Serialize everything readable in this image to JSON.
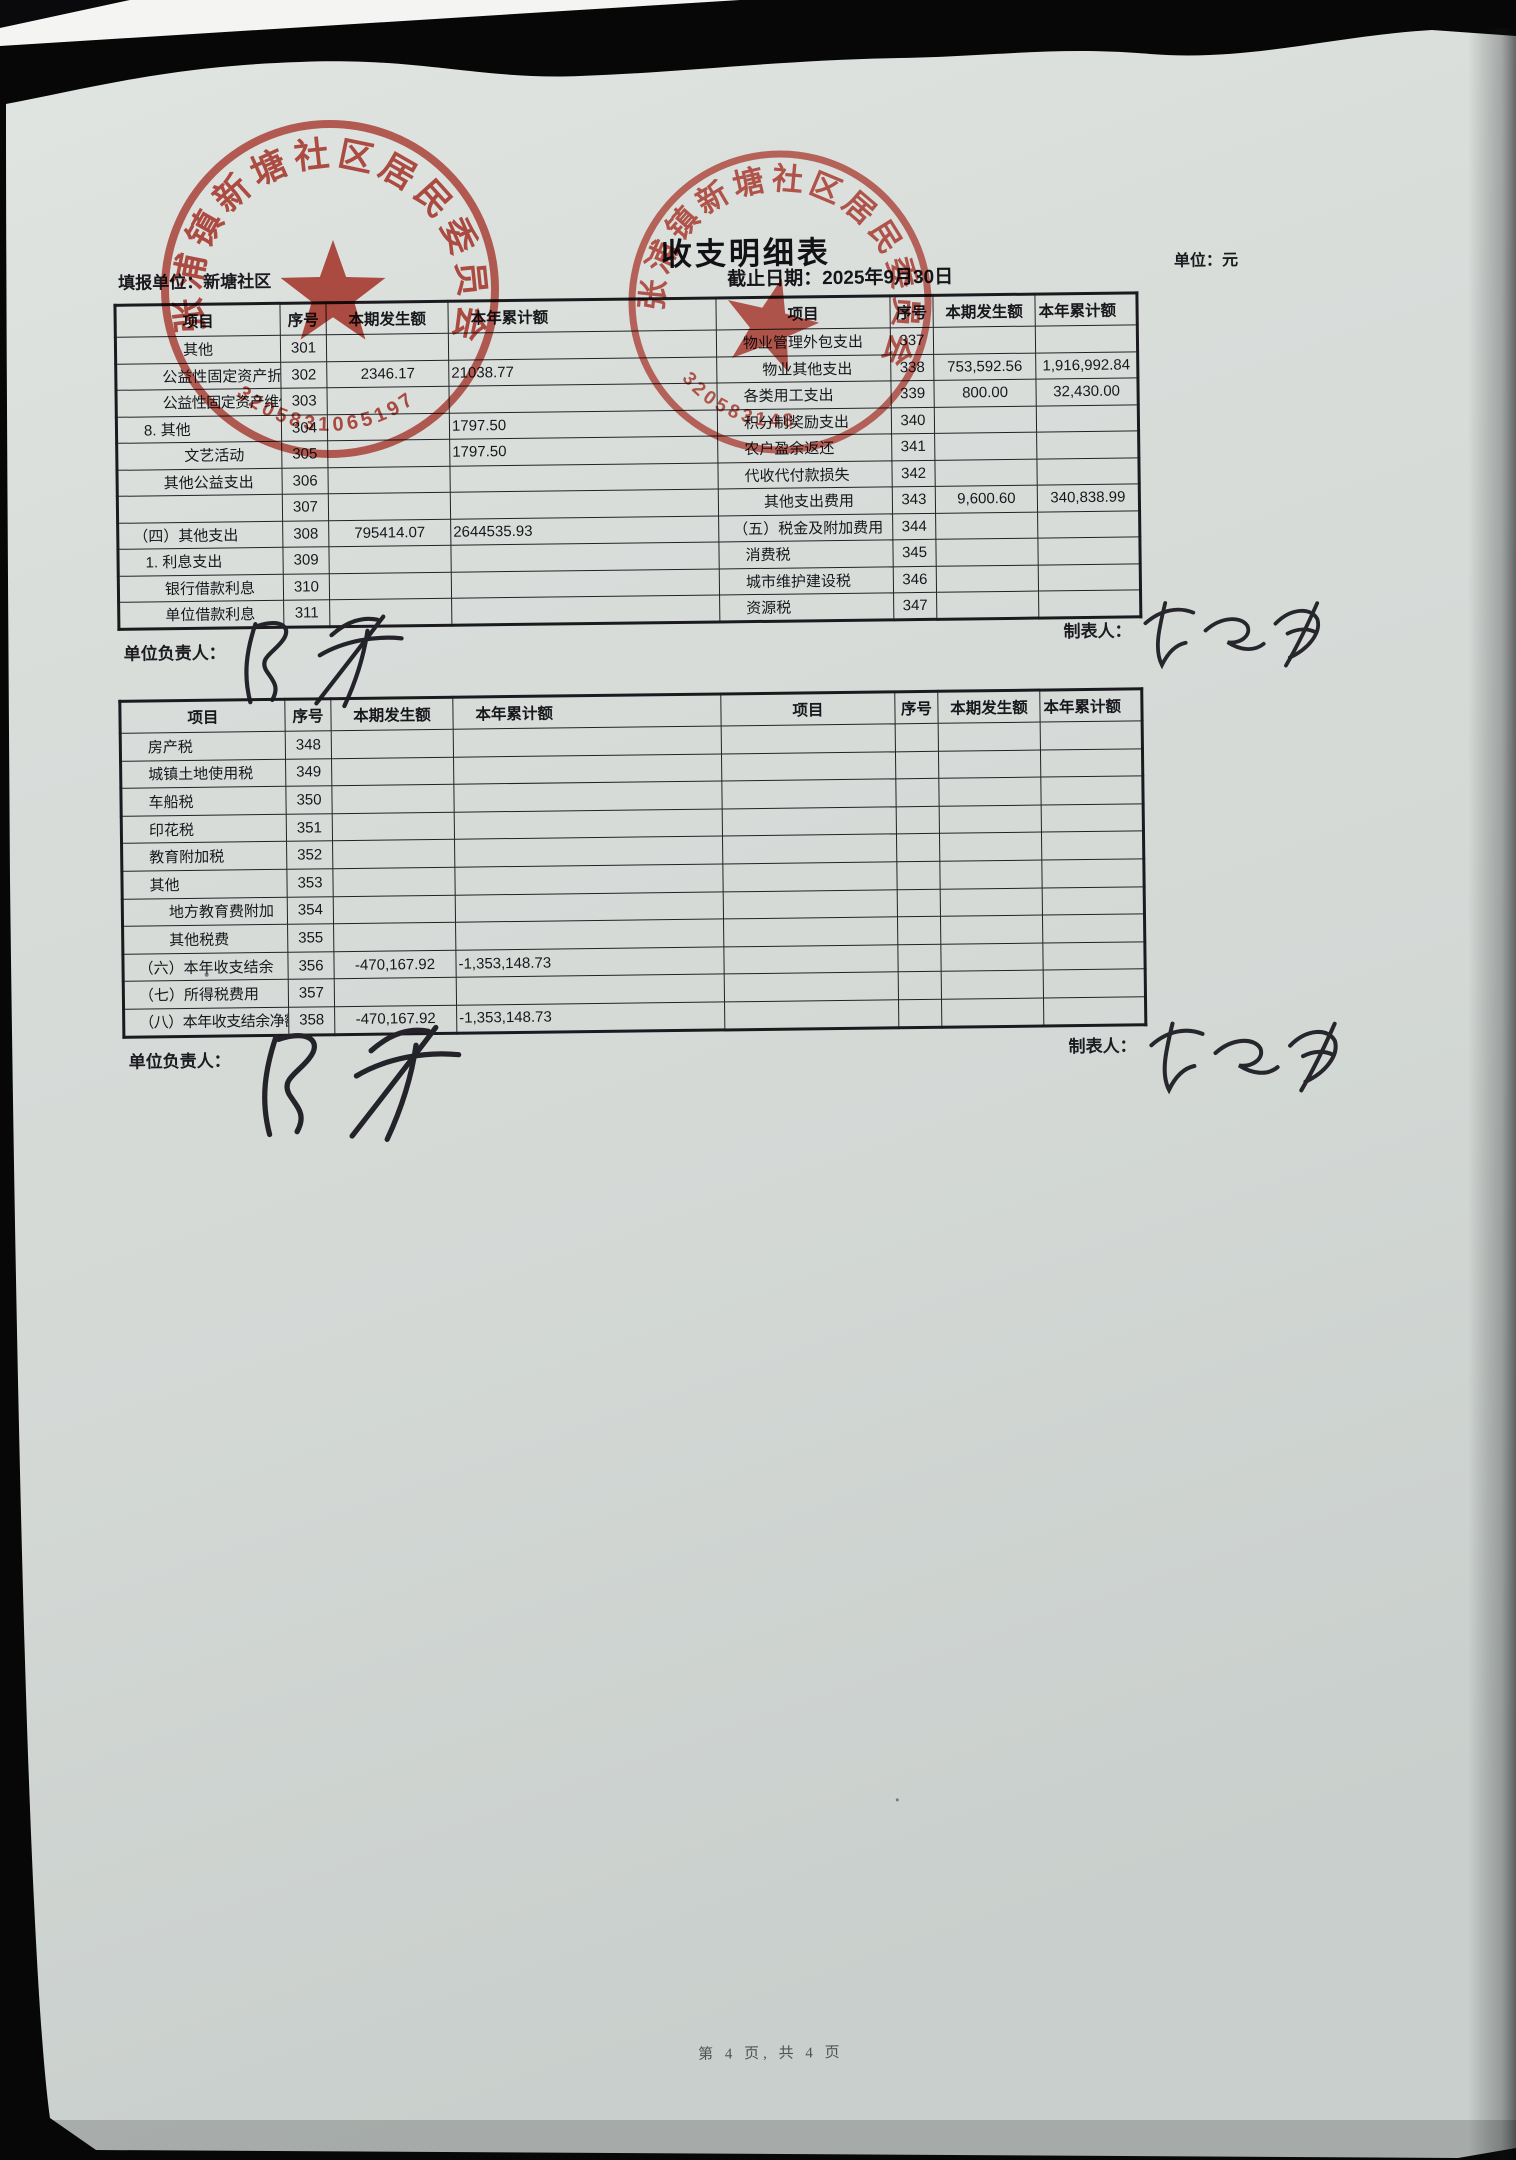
{
  "page": {
    "title": "收支明细表",
    "report_unit_label": "填报单位：",
    "report_unit": "新塘社区",
    "deadline_label": "截止日期：",
    "deadline": "2025年9月30日",
    "unit_label": "单位：",
    "unit": "元",
    "footer": "第 4 页, 共 4 页"
  },
  "table_headers": [
    "项目",
    "序号",
    "本期发生额",
    "本年累计额",
    "项目",
    "序号",
    "本期发生额",
    "本年累计额"
  ],
  "signers": {
    "responsible_label": "单位负责人：",
    "responsible_name": "陈华",
    "preparer_label": "制表人：",
    "preparer_name": "蔡丽娟"
  },
  "stamps": [
    {
      "org": "张浦镇新塘社区居民委员会",
      "number": "3205831065197"
    },
    {
      "org": "张浦镇新塘社区居民委员会",
      "number": "320583148"
    }
  ],
  "table1": {
    "rows": [
      {
        "label": "其他",
        "indent": 3,
        "seq": "301",
        "amount": "",
        "cumulative": "",
        "label2": "物业管理外包支出",
        "indent2": 1,
        "seq2": "337",
        "amount2": "",
        "cumulative2": ""
      },
      {
        "label": "公益性固定资产折旧",
        "indent": 2,
        "seq": "302",
        "amount": "2346.17",
        "cumulative": "21038.77",
        "label2": "物业其他支出",
        "indent2": 2,
        "seq2": "338",
        "amount2": "753,592.56",
        "cumulative2": "1,916,992.84"
      },
      {
        "label": "公益性固定资产维修（护）",
        "indent": 2,
        "seq": "303",
        "amount": "",
        "cumulative": "",
        "label2": "各类用工支出",
        "indent2": 1,
        "seq2": "339",
        "amount2": "800.00",
        "cumulative2": "32,430.00"
      },
      {
        "label": "8. 其他",
        "indent": 1,
        "seq": "304",
        "amount": "",
        "cumulative": "1797.50",
        "label2": "积分制奖励支出",
        "indent2": 1,
        "seq2": "340",
        "amount2": "",
        "cumulative2": ""
      },
      {
        "label": "文艺活动",
        "indent": 3,
        "seq": "305",
        "amount": "",
        "cumulative": "1797.50",
        "label2": "农户盈余返还",
        "indent2": 1,
        "seq2": "341",
        "amount2": "",
        "cumulative2": ""
      },
      {
        "label": "其他公益支出",
        "indent": 2,
        "seq": "306",
        "amount": "",
        "cumulative": "",
        "label2": "代收代付款损失",
        "indent2": 1,
        "seq2": "342",
        "amount2": "",
        "cumulative2": ""
      },
      {
        "label": "",
        "indent": 0,
        "seq": "307",
        "amount": "",
        "cumulative": "",
        "label2": "其他支出费用",
        "indent2": 2,
        "seq2": "343",
        "amount2": "9,600.60",
        "cumulative2": "340,838.99"
      },
      {
        "label": "（四）其他支出",
        "indent": 0,
        "seq": "308",
        "amount": "795414.07",
        "cumulative": "2644535.93",
        "label2": "（五）税金及附加费用",
        "indent2": 0,
        "seq2": "344",
        "amount2": "",
        "cumulative2": ""
      },
      {
        "label": "1. 利息支出",
        "indent": 1,
        "seq": "309",
        "amount": "",
        "cumulative": "",
        "label2": "消费税",
        "indent2": 1,
        "seq2": "345",
        "amount2": "",
        "cumulative2": ""
      },
      {
        "label": "银行借款利息",
        "indent": 2,
        "seq": "310",
        "amount": "",
        "cumulative": "",
        "label2": "城市维护建设税",
        "indent2": 1,
        "seq2": "346",
        "amount2": "",
        "cumulative2": ""
      },
      {
        "label": "单位借款利息",
        "indent": 2,
        "seq": "311",
        "amount": "",
        "cumulative": "",
        "label2": "资源税",
        "indent2": 1,
        "seq2": "347",
        "amount2": "",
        "cumulative2": ""
      }
    ]
  },
  "table2": {
    "rows": [
      {
        "label": "房产税",
        "indent": 1,
        "seq": "348",
        "amount": "",
        "cumulative": "",
        "label2": "",
        "indent2": 0,
        "seq2": "",
        "amount2": "",
        "cumulative2": ""
      },
      {
        "label": "城镇土地使用税",
        "indent": 1,
        "seq": "349",
        "amount": "",
        "cumulative": "",
        "label2": "",
        "indent2": 0,
        "seq2": "",
        "amount2": "",
        "cumulative2": ""
      },
      {
        "label": "车船税",
        "indent": 1,
        "seq": "350",
        "amount": "",
        "cumulative": "",
        "label2": "",
        "indent2": 0,
        "seq2": "",
        "amount2": "",
        "cumulative2": ""
      },
      {
        "label": "印花税",
        "indent": 1,
        "seq": "351",
        "amount": "",
        "cumulative": "",
        "label2": "",
        "indent2": 0,
        "seq2": "",
        "amount2": "",
        "cumulative2": ""
      },
      {
        "label": "教育附加税",
        "indent": 1,
        "seq": "352",
        "amount": "",
        "cumulative": "",
        "label2": "",
        "indent2": 0,
        "seq2": "",
        "amount2": "",
        "cumulative2": ""
      },
      {
        "label": "其他",
        "indent": 1,
        "seq": "353",
        "amount": "",
        "cumulative": "",
        "label2": "",
        "indent2": 0,
        "seq2": "",
        "amount2": "",
        "cumulative2": ""
      },
      {
        "label": "地方教育费附加",
        "indent": 2,
        "seq": "354",
        "amount": "",
        "cumulative": "",
        "label2": "",
        "indent2": 0,
        "seq2": "",
        "amount2": "",
        "cumulative2": ""
      },
      {
        "label": "其他税费",
        "indent": 2,
        "seq": "355",
        "amount": "",
        "cumulative": "",
        "label2": "",
        "indent2": 0,
        "seq2": "",
        "amount2": "",
        "cumulative2": ""
      },
      {
        "label": "（六）本年收支结余",
        "indent": 0,
        "seq": "356",
        "amount": "-470,167.92",
        "cumulative": "-1,353,148.73",
        "label2": "",
        "indent2": 0,
        "seq2": "",
        "amount2": "",
        "cumulative2": ""
      },
      {
        "label": "（七）所得税费用",
        "indent": 0,
        "seq": "357",
        "amount": "",
        "cumulative": "",
        "label2": "",
        "indent2": 0,
        "seq2": "",
        "amount2": "",
        "cumulative2": ""
      },
      {
        "label": "（八）本年收支结余净额",
        "indent": 0,
        "seq": "358",
        "amount": "-470,167.92",
        "cumulative": "-1,353,148.73",
        "label2": "",
        "indent2": 0,
        "seq2": "",
        "amount2": "",
        "cumulative2": ""
      }
    ]
  }
}
